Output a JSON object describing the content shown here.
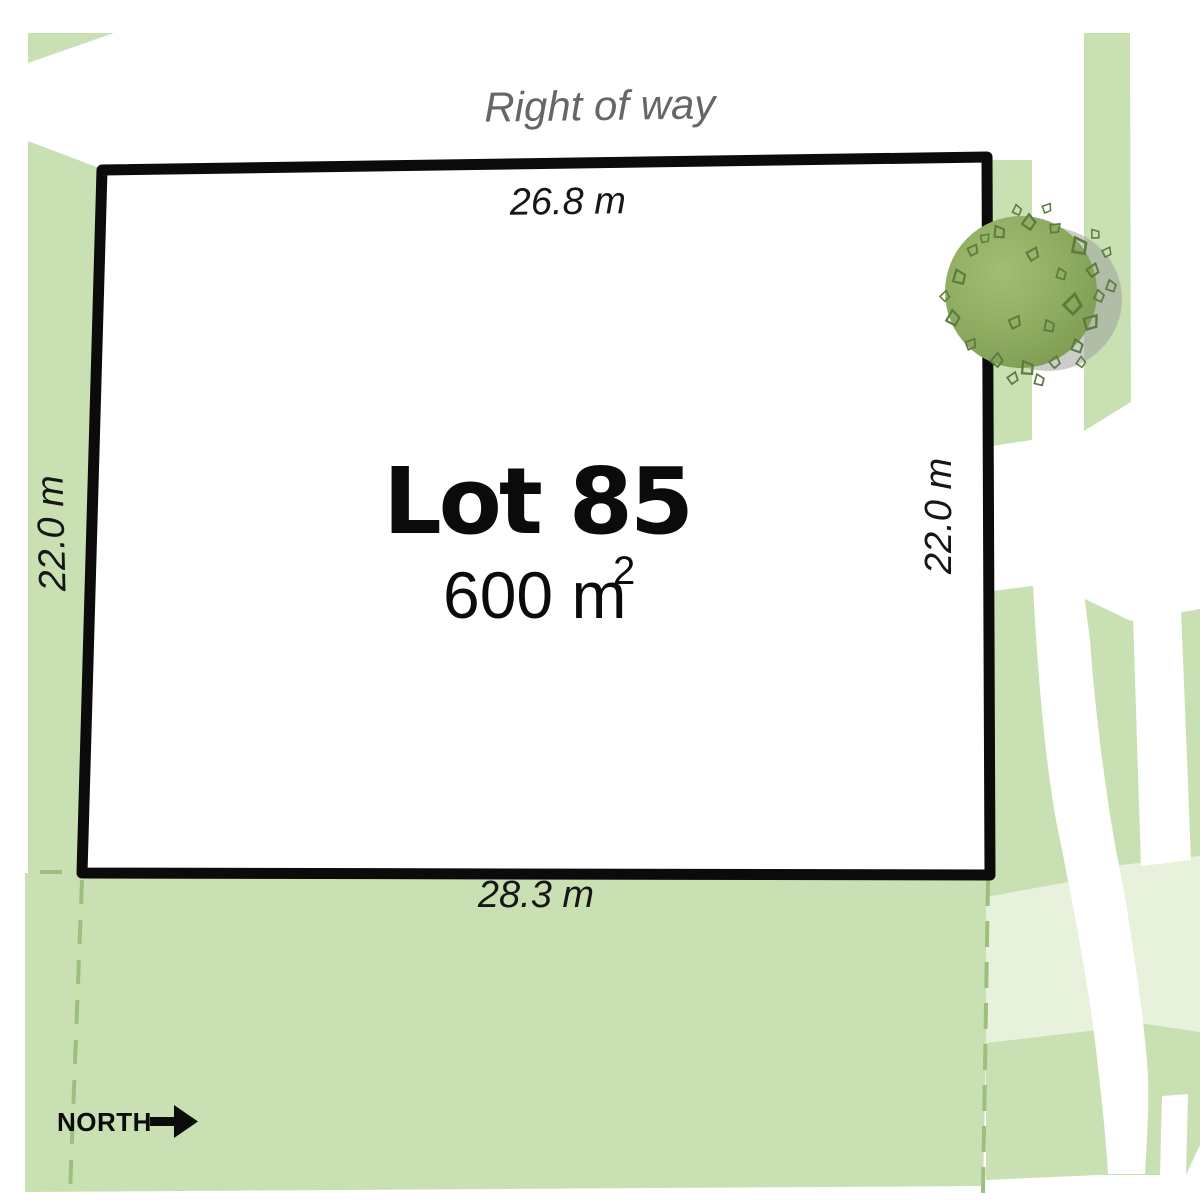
{
  "plan": {
    "lot_name": "Lot 85",
    "area_base": "600 m",
    "area_exponent": "2",
    "right_of_way": "Right of way",
    "north_label": "NORTH",
    "dimensions": {
      "top": "26.8 m",
      "left": "22.0 m",
      "right": "22.0 m",
      "bottom": "28.3 m"
    }
  },
  "icons": {
    "north_arrow": "north-arrow-icon",
    "tree": "tree-icon"
  },
  "colors": {
    "greenspace": "#c9e1b2",
    "greenspace_light": "#e7f1dc",
    "boundary_dash": "#9dbf7e",
    "lot_border": "#0b0b0b",
    "lot_fill": "#ffffff",
    "road": "#ffffff",
    "tree_dark": "#7d9b50",
    "tree_light": "#a3bd74",
    "tree_leaf_stroke": "#5c7b3e",
    "tree_shadow": "#9a9a9a",
    "right_of_way_text": "#666666"
  }
}
